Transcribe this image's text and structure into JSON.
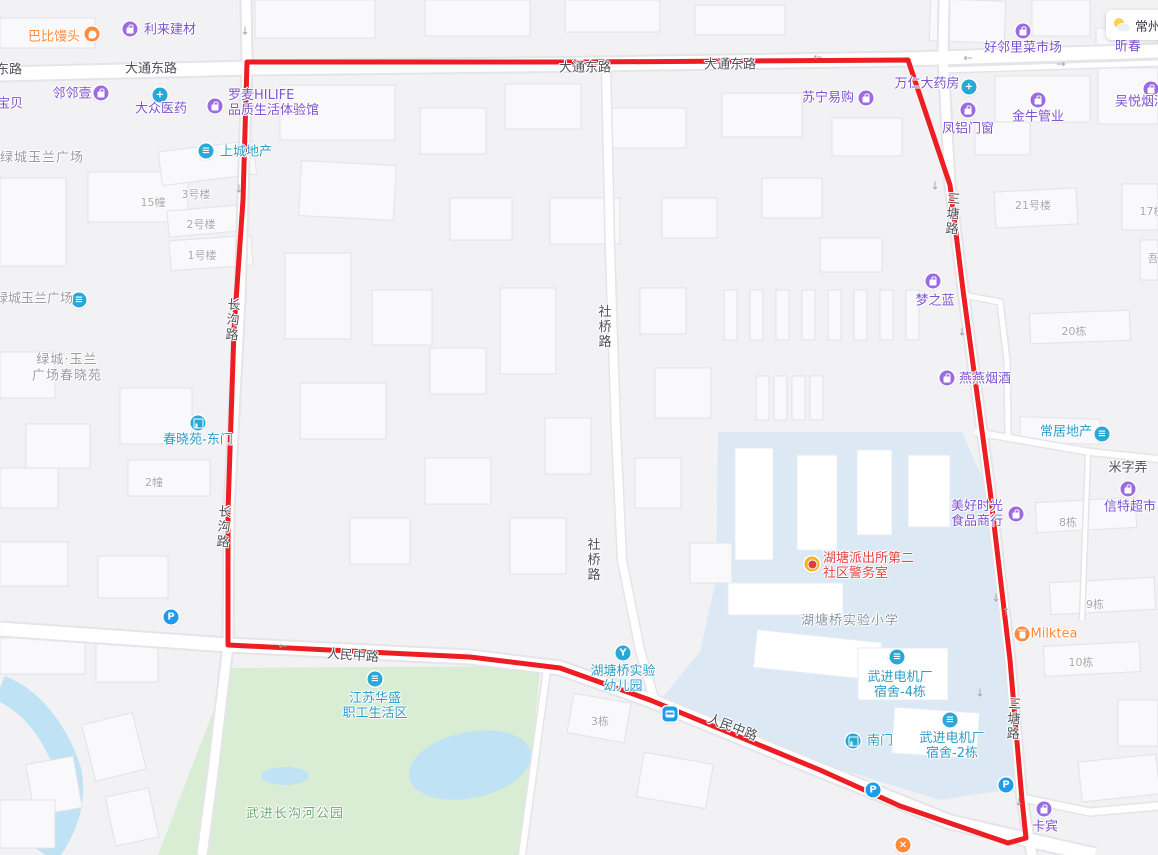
{
  "colors": {
    "boundary_red": "#ed1d24",
    "poi_purple": "#7d52d1",
    "poi_cyan": "#2e9dc9",
    "poi_orange": "#ff8a3c",
    "poi_red": "#e34444",
    "park_green_fill": "#d8edd3",
    "campus_blue_fill": "#dce9f5",
    "water_fill": "#bfe2f5"
  },
  "weather": {
    "city": "常州"
  },
  "labels": {
    "roads": [
      {
        "t": "东路",
        "x": 9,
        "y": 68
      },
      {
        "t": "大通东路",
        "x": 151,
        "y": 67
      },
      {
        "t": "大通东路",
        "x": 585,
        "y": 66
      },
      {
        "t": "大通东路",
        "x": 730,
        "y": 63
      },
      {
        "t": "人民中路",
        "x": 353,
        "y": 654,
        "rot": 4
      },
      {
        "t": "人民中路",
        "x": 733,
        "y": 726,
        "rot": 21
      },
      {
        "t": "社桥路",
        "x": 603,
        "y": 327,
        "v": 1
      },
      {
        "t": "社桥路",
        "x": 592,
        "y": 560,
        "v": 1
      },
      {
        "t": "长沟路",
        "x": 231,
        "y": 320,
        "v": 1,
        "rot": 4
      },
      {
        "t": "长沟路",
        "x": 222,
        "y": 527,
        "v": 1,
        "rot": 4
      },
      {
        "t": "三塘路",
        "x": 951,
        "y": 214,
        "v": 1,
        "rot": 4
      },
      {
        "t": "三塘路",
        "x": 1012,
        "y": 719,
        "v": 1,
        "rot": 3
      },
      {
        "t": "米字弄",
        "x": 1128,
        "y": 466
      }
    ],
    "buildings": [
      {
        "t": "15幢",
        "x": 153,
        "y": 202
      },
      {
        "t": "3号楼",
        "x": 196,
        "y": 194
      },
      {
        "t": "2号楼",
        "x": 201,
        "y": 224
      },
      {
        "t": "1号楼",
        "x": 202,
        "y": 255
      },
      {
        "t": "2幢",
        "x": 154,
        "y": 482
      },
      {
        "t": "21号楼",
        "x": 1033,
        "y": 205
      },
      {
        "t": "17栋",
        "x": 1152,
        "y": 211
      },
      {
        "t": "20栋",
        "x": 1074,
        "y": 331
      },
      {
        "t": "8栋",
        "x": 1068,
        "y": 522
      },
      {
        "t": "9栋",
        "x": 1095,
        "y": 604
      },
      {
        "t": "10栋",
        "x": 1081,
        "y": 662
      },
      {
        "t": "3栋",
        "x": 600,
        "y": 721
      },
      {
        "t": "吾",
        "x": 1153,
        "y": 258
      }
    ],
    "areas": [
      {
        "t": "绿城玉兰广场",
        "x": 42,
        "y": 156
      },
      {
        "t": "绿城·玉兰",
        "x": 67,
        "y": 358
      },
      {
        "t": "广场春晓苑",
        "x": 67,
        "y": 374
      },
      {
        "t": "湖塘桥实验小学",
        "x": 850,
        "y": 619,
        "cls": "school"
      },
      {
        "t": "武进长沟河公园",
        "x": 295,
        "y": 812,
        "cls": "park"
      }
    ]
  },
  "pois": [
    {
      "n": "babi-mantou",
      "lines": [
        "巴比馒头"
      ],
      "c": "orange",
      "icon": "hand",
      "ic": "orange",
      "ix": 92,
      "iy": 34,
      "tx": 54,
      "ty": 37
    },
    {
      "n": "lilai-jiancai",
      "lines": [
        "利来建材"
      ],
      "c": "purple",
      "icon": "bag",
      "ic": "purple",
      "ix": 130,
      "iy": 29,
      "tx": 170,
      "ty": 30
    },
    {
      "n": "linlinyi",
      "lines": [
        "邻邻壹"
      ],
      "c": "purple",
      "icon": "bag",
      "ic": "purple",
      "ix": 101,
      "iy": 93,
      "tx": 72,
      "ty": 94
    },
    {
      "n": "baobei",
      "lines": [
        "宝贝"
      ],
      "c": "purple",
      "tx": 10,
      "ty": 104
    },
    {
      "n": "dazhong-yiyao",
      "lines": [
        "大众医药"
      ],
      "c": "purple",
      "icon": "cross",
      "ic": "cyan",
      "ix": 160,
      "iy": 95,
      "tx": 161,
      "ty": 109
    },
    {
      "n": "luomai-hilife",
      "lines": [
        "罗麦HILIFE",
        "品质生活体验馆"
      ],
      "c": "purple",
      "icon": "bag",
      "ic": "purple",
      "ix": 215,
      "iy": 106,
      "tx": 228,
      "ty": 103,
      "align": "left"
    },
    {
      "n": "shangcheng-dichan",
      "lines": [
        "上城地产"
      ],
      "c": "cyan",
      "icon": "bldg",
      "ic": "cyan",
      "ix": 206,
      "iy": 151,
      "tx": 246,
      "ty": 152
    },
    {
      "n": "suning-yigou",
      "lines": [
        "苏宁易购"
      ],
      "c": "purple",
      "icon": "bag",
      "ic": "purple",
      "ix": 866,
      "iy": 98,
      "tx": 828,
      "ty": 98
    },
    {
      "n": "wanren-dayaofang",
      "lines": [
        "万仁大药房"
      ],
      "c": "purple",
      "icon": "cross",
      "ic": "cyan",
      "ix": 969,
      "iy": 87,
      "tx": 927,
      "ty": 84
    },
    {
      "n": "fenglv-menchuang",
      "lines": [
        "凤铝门窗"
      ],
      "c": "purple",
      "icon": "bag",
      "ic": "purple",
      "ix": 968,
      "iy": 110,
      "tx": 968,
      "ty": 129
    },
    {
      "n": "jinniu-guanye",
      "lines": [
        "金牛管业"
      ],
      "c": "purple",
      "icon": "bag",
      "ic": "purple",
      "ix": 1038,
      "iy": 100,
      "tx": 1038,
      "ty": 117
    },
    {
      "n": "wuyue-yanjiu",
      "lines": [
        "吴悦烟酒"
      ],
      "c": "purple",
      "icon": "bag",
      "ic": "purple",
      "ix": 1151,
      "iy": 89,
      "tx": 1141,
      "ty": 102
    },
    {
      "n": "haolinli-caishichang",
      "lines": [
        "好邻里菜市场"
      ],
      "c": "purple",
      "icon": "bag",
      "ic": "purple",
      "ix": 1023,
      "iy": 31,
      "tx": 1023,
      "ty": 48
    },
    {
      "n": "xinchun-partial",
      "lines": [
        "昕春"
      ],
      "c": "purple",
      "tx": 1128,
      "ty": 47
    },
    {
      "n": "mengzhilan",
      "lines": [
        "梦之蓝"
      ],
      "c": "purple",
      "icon": "bag",
      "ic": "purple",
      "ix": 933,
      "iy": 281,
      "tx": 935,
      "ty": 301
    },
    {
      "n": "yanyan-yanjiu",
      "lines": [
        "燕燕烟酒"
      ],
      "c": "purple",
      "icon": "bag",
      "ic": "purple",
      "ix": 947,
      "iy": 378,
      "tx": 985,
      "ty": 379
    },
    {
      "n": "meihao-shiguang",
      "lines": [
        "美好时光",
        "食品商行"
      ],
      "c": "purple",
      "icon": "bag",
      "ic": "purple",
      "ix": 1016,
      "iy": 514,
      "tx": 977,
      "ty": 514
    },
    {
      "n": "xinte-chaoshi",
      "lines": [
        "信特超市"
      ],
      "c": "purple",
      "icon": "basket",
      "ic": "purple",
      "ix": 1128,
      "iy": 489,
      "tx": 1130,
      "ty": 507
    },
    {
      "n": "kabin",
      "lines": [
        "卡宾"
      ],
      "c": "purple",
      "icon": "bag",
      "ic": "purple",
      "ix": 1044,
      "iy": 809,
      "tx": 1045,
      "ty": 827
    },
    {
      "n": "lvcheng-yulan-south",
      "lines": [
        "绿城玉兰广场"
      ],
      "c": "gray",
      "icon": "bldg",
      "ic": "cyan",
      "ix": 79,
      "iy": 300,
      "tx": 34,
      "ty": 299
    },
    {
      "n": "chunxiaoyuan-dongmen",
      "lines": [
        "春晓苑-东门"
      ],
      "c": "cyan",
      "icon": "gate",
      "ic": "cyan",
      "ix": 198,
      "iy": 423,
      "tx": 198,
      "ty": 440
    },
    {
      "n": "jiangsu-huasheng",
      "lines": [
        "江苏华盛",
        "职工生活区"
      ],
      "c": "cyan",
      "icon": "bldg",
      "ic": "cyan",
      "ix": 375,
      "iy": 679,
      "tx": 375,
      "ty": 706
    },
    {
      "n": "hutangqiao-youeryuan",
      "lines": [
        "湖塘桥实验",
        "幼儿园"
      ],
      "c": "cyan",
      "icon": "pinwheel",
      "ic": "cyan",
      "ix": 623,
      "iy": 653,
      "tx": 623,
      "ty": 679
    },
    {
      "n": "wujin-dianjichang-sushe4",
      "lines": [
        "武进电机厂",
        "宿舍-4栋"
      ],
      "c": "cyan",
      "icon": "bldg",
      "ic": "cyan",
      "ix": 897,
      "iy": 657,
      "tx": 900,
      "ty": 685
    },
    {
      "n": "nanmen",
      "lines": [
        "南门"
      ],
      "c": "cyan",
      "icon": "gate",
      "ic": "cyan",
      "ix": 853,
      "iy": 741,
      "tx": 880,
      "ty": 741
    },
    {
      "n": "wujin-dianjichang-sushe2",
      "lines": [
        "武进电机厂",
        "宿舍-2栋"
      ],
      "c": "cyan",
      "icon": "bldg",
      "ic": "cyan",
      "ix": 950,
      "iy": 720,
      "tx": 952,
      "ty": 746
    },
    {
      "n": "changju-dichan",
      "lines": [
        "常居地产"
      ],
      "c": "cyan",
      "icon": "bldg",
      "ic": "cyan",
      "ix": 1102,
      "iy": 434,
      "tx": 1066,
      "ty": 432
    },
    {
      "n": "hutang-paichusuo-jingwushi",
      "lines": [
        "湖塘派出所第二",
        "社区警务室"
      ],
      "c": "red",
      "icon": "badge",
      "ic": "gold",
      "ix": 812,
      "iy": 564,
      "tx": 823,
      "ty": 566,
      "align": "left"
    },
    {
      "n": "milktea",
      "lines": [
        "Milktea"
      ],
      "c": "orange",
      "icon": "cup",
      "ic": "orange",
      "ix": 1022,
      "iy": 634,
      "tx": 1054,
      "ty": 634
    },
    {
      "n": "closed-marker",
      "lines": [],
      "icon": "close",
      "ic": "orange",
      "ix": 903,
      "iy": 845
    },
    {
      "n": "parking-west",
      "lines": [],
      "icon": "parking",
      "ic": "blue",
      "ix": 171,
      "iy": 617
    },
    {
      "n": "parking-south",
      "lines": [],
      "icon": "parking",
      "ic": "blue",
      "ix": 873,
      "iy": 790
    },
    {
      "n": "parking-southeast",
      "lines": [],
      "icon": "parking",
      "ic": "blue",
      "ix": 1006,
      "iy": 785
    },
    {
      "n": "bus-stop",
      "lines": [],
      "icon": "bus",
      "ic": "blue",
      "ix": 670,
      "iy": 714
    }
  ],
  "arrows": [
    {
      "x": 245,
      "y": 31,
      "d": "↓"
    },
    {
      "x": 239,
      "y": 189,
      "d": "↓"
    },
    {
      "x": 935,
      "y": 186,
      "d": "↓"
    },
    {
      "x": 962,
      "y": 332,
      "d": "↓"
    },
    {
      "x": 996,
      "y": 598,
      "d": "↓"
    },
    {
      "x": 1006,
      "y": 612,
      "d": "↑"
    },
    {
      "x": 980,
      "y": 693,
      "d": "↓"
    },
    {
      "x": 1019,
      "y": 802,
      "d": "↓"
    },
    {
      "x": 283,
      "y": 646,
      "d": "←"
    },
    {
      "x": 968,
      "y": 58,
      "d": "←"
    },
    {
      "x": 1061,
      "y": 64,
      "d": "→"
    },
    {
      "x": 818,
      "y": 57,
      "d": "←"
    }
  ]
}
